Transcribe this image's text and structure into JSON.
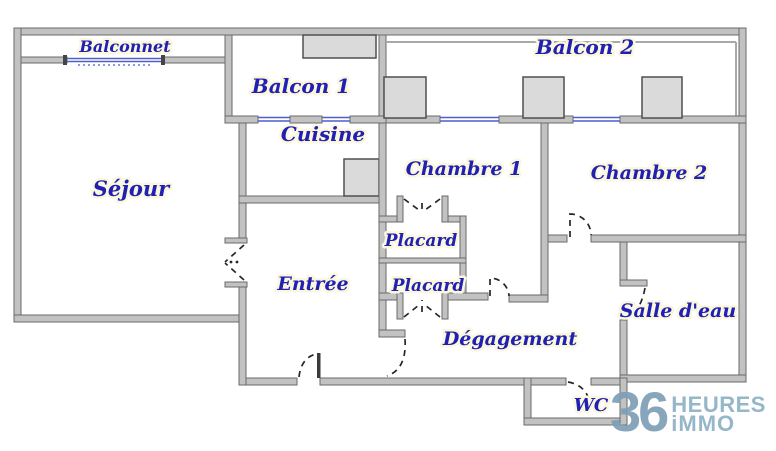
{
  "plan": {
    "rooms": [
      {
        "id": "balconnet",
        "label": "Balconnet"
      },
      {
        "id": "balcon-1",
        "label": "Balcon 1"
      },
      {
        "id": "balcon-2",
        "label": "Balcon 2"
      },
      {
        "id": "sejour",
        "label": "Séjour"
      },
      {
        "id": "cuisine",
        "label": "Cuisine"
      },
      {
        "id": "chambre-1",
        "label": "Chambre 1"
      },
      {
        "id": "chambre-2",
        "label": "Chambre 2"
      },
      {
        "id": "placard-haut",
        "label": "Placard"
      },
      {
        "id": "placard-bas",
        "label": "Placard"
      },
      {
        "id": "entree",
        "label": "Entrée"
      },
      {
        "id": "degagement",
        "label": "Dégagement"
      },
      {
        "id": "salle-eau",
        "label": "Salle d'eau"
      },
      {
        "id": "wc",
        "label": "WC"
      }
    ]
  },
  "logo": {
    "number": "36",
    "word1": "HEURES",
    "word2": "iMMO"
  },
  "colors": {
    "label_text": "#2020b2",
    "wall_fill": "#c2c2c2",
    "wall_edge": "#6a6a6a",
    "window_glass": "#4d5fc9",
    "pillar_fill": "#dadada",
    "pillar_edge": "#4f4f4f",
    "door_line": "#262626",
    "logo_number": "#7e9fb6",
    "logo_text": "#8db1c5",
    "background": "#ffffff"
  }
}
